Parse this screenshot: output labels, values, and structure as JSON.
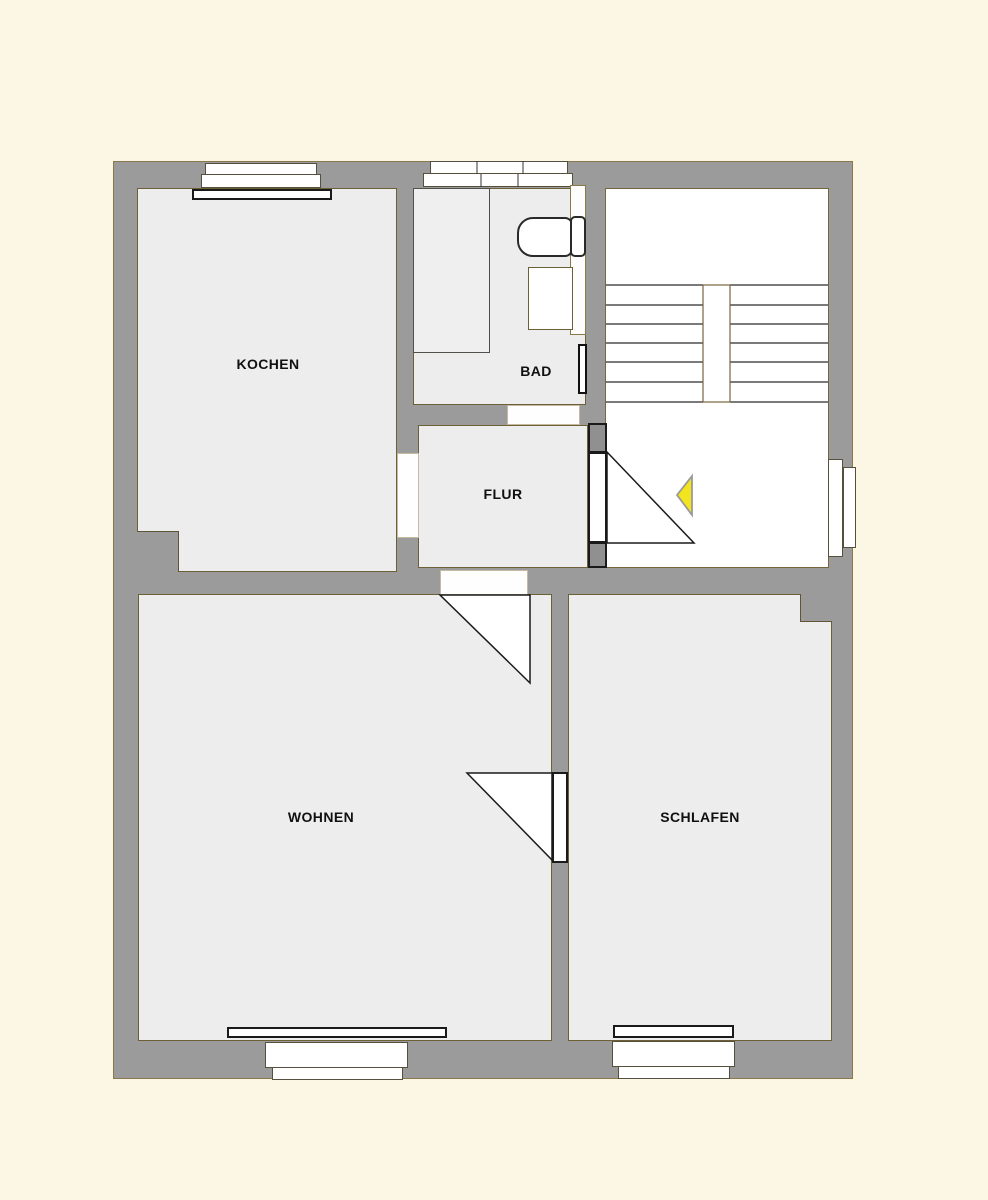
{
  "plan": {
    "kind": "apartment-floor-plan",
    "rooms": [
      {
        "id": "kochen",
        "label": "KOCHEN"
      },
      {
        "id": "bad",
        "label": "BAD"
      },
      {
        "id": "flur",
        "label": "FLUR"
      },
      {
        "id": "wohnen",
        "label": "WOHNEN"
      },
      {
        "id": "schlafen",
        "label": "SCHLAFEN"
      }
    ],
    "symbols": {
      "stairs": "staircase-with-center-divider",
      "entrance_arrow": "yellow-left-pointing-triangle",
      "doors": [
        "entry-door",
        "flur-wohnen-door",
        "wohnen-schlafen-door"
      ],
      "door_openings": [
        "kochen-flur-opening",
        "bad-flur-opening"
      ],
      "windows": [
        "kochen-top-window",
        "bad-top-window",
        "stairwell-right-window",
        "wohnen-bottom-window",
        "schlafen-bottom-window"
      ],
      "fixtures": [
        "bathtub",
        "toilet",
        "sink",
        "radiator",
        "duct-shaft"
      ]
    },
    "colors": {
      "background": "#fcf6e5",
      "wall_gray": "#9b9b9b",
      "floor_gray": "#ededee",
      "white_area": "#ffffff",
      "outline_tan": "#77663c",
      "line_dark": "#1a1a1a",
      "entrance_arrow_yellow": "#f2e41e"
    }
  }
}
